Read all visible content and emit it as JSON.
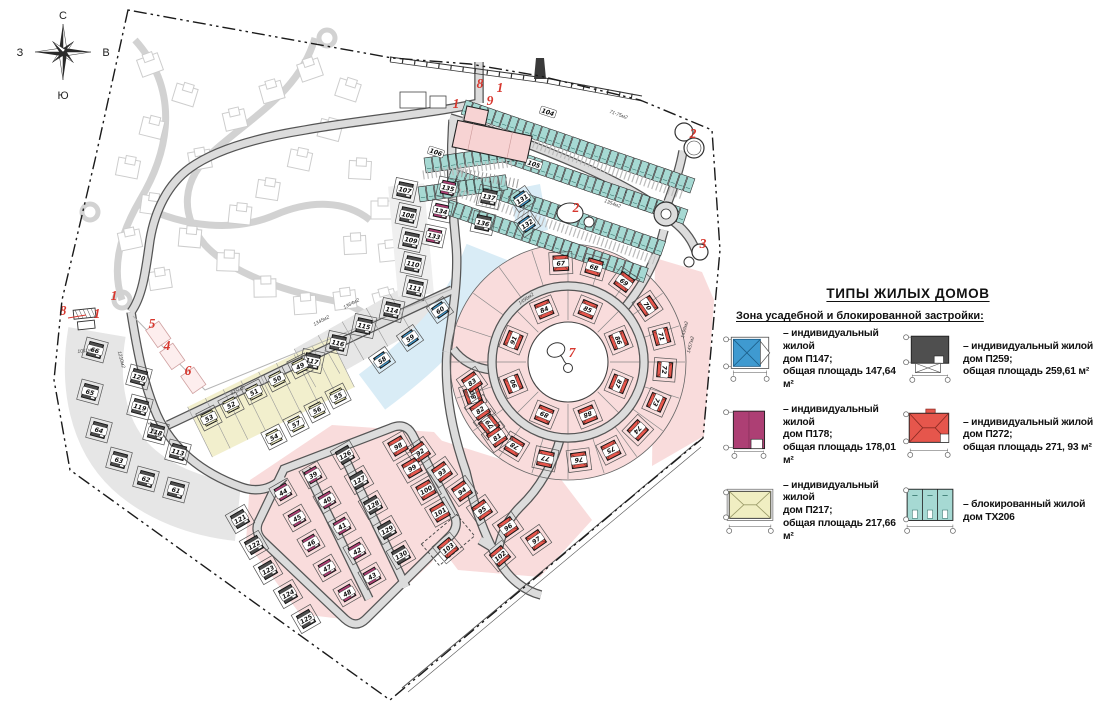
{
  "compass": {
    "n": "С",
    "s": "Ю",
    "w": "З",
    "e": "В"
  },
  "legend": {
    "title": "ТИПЫ ЖИЛЫХ ДОМОВ",
    "subtitle": "Зона усадебной и блокированной застройки:",
    "items": [
      {
        "id": "p147",
        "type": "П147",
        "house_color": "#3f9ad0",
        "lines": [
          "– индивидуальный жилой",
          "дом П147;",
          "общая площадь 147,64 м²"
        ]
      },
      {
        "id": "p259",
        "type": "П259",
        "house_color": "#4f4f4f",
        "lines": [
          "– индивидуальный жилой",
          "дом П259;",
          "общая площадь 259,61 м²"
        ]
      },
      {
        "id": "p178",
        "type": "П178",
        "house_color": "#ad3f74",
        "lines": [
          "– индивидуальный жилой",
          "дом П178;",
          "общая площадь 178,01 м²"
        ]
      },
      {
        "id": "p272",
        "type": "П272",
        "house_color": "#e6564c",
        "lines": [
          "– индивидуальный жилой",
          "дом П272;",
          "общая площадь 271, 93 м²"
        ]
      },
      {
        "id": "p217",
        "type": "П217",
        "house_color": "#f0eec2",
        "lines": [
          "– индивидуальный жилой",
          "дом П217;",
          "общая площадь 217,66 м²"
        ]
      },
      {
        "id": "tx206",
        "type": "ТХ206",
        "house_color": "#a6d9d3",
        "lines": [
          "– блокированный жилой",
          "дом ТХ206"
        ]
      }
    ]
  },
  "map": {
    "markers": [
      {
        "n": "1",
        "x": 114,
        "y": 300
      },
      {
        "n": "8",
        "x": 63,
        "y": 315
      },
      {
        "n": "1",
        "x": 97,
        "y": 318
      },
      {
        "n": "5",
        "x": 152,
        "y": 328
      },
      {
        "n": "4",
        "x": 167,
        "y": 350
      },
      {
        "n": "6",
        "x": 188,
        "y": 375
      },
      {
        "n": "1",
        "x": 456,
        "y": 108
      },
      {
        "n": "8",
        "x": 480,
        "y": 88
      },
      {
        "n": "1",
        "x": 500,
        "y": 92
      },
      {
        "n": "9",
        "x": 490,
        "y": 105
      },
      {
        "n": "2",
        "x": 693,
        "y": 138
      },
      {
        "n": "2",
        "x": 576,
        "y": 212
      },
      {
        "n": "3",
        "x": 703,
        "y": 248
      },
      {
        "n": "7",
        "x": 572,
        "y": 357
      }
    ],
    "zones": [
      {
        "name": "gray-arc",
        "type": "П259",
        "numbers": [
          "66",
          "65",
          "64",
          "63",
          "62",
          "61",
          "120",
          "119",
          "118",
          "113"
        ]
      },
      {
        "name": "gray-top-col",
        "type": "П259",
        "numbers": [
          "107",
          "108",
          "109",
          "110",
          "111",
          "114",
          "115",
          "116",
          "117"
        ]
      },
      {
        "name": "gray-grid-west",
        "type": "П259",
        "numbers": [
          "121",
          "122",
          "123",
          "124",
          "125"
        ]
      },
      {
        "name": "gray-grid-east",
        "type": "П259",
        "numbers": [
          "126",
          "127",
          "128",
          "129",
          "130"
        ]
      },
      {
        "name": "magenta-grid",
        "type": "П178",
        "numbers": [
          "44",
          "45",
          "46",
          "47",
          "48",
          "39",
          "40",
          "41",
          "42",
          "43"
        ]
      },
      {
        "name": "magenta-top",
        "type": "П178",
        "numbers": [
          "135",
          "134",
          "133"
        ]
      },
      {
        "name": "dark-top",
        "type": "П259",
        "numbers": [
          "137",
          "136"
        ]
      },
      {
        "name": "yellow-band",
        "type": "П217",
        "numbers": [
          "49",
          "50",
          "51",
          "52",
          "53",
          "55",
          "56",
          "57",
          "54"
        ]
      },
      {
        "name": "blue-band",
        "type": "П147",
        "numbers": [
          "58",
          "59",
          "60",
          "131",
          "132"
        ]
      },
      {
        "name": "circle-inner",
        "type": "П272",
        "numbers": [
          "84",
          "85",
          "86",
          "87",
          "88",
          "89",
          "90",
          "91"
        ]
      },
      {
        "name": "circle-outer",
        "type": "П272",
        "numbers": [
          "67",
          "68",
          "69",
          "70",
          "71",
          "72",
          "73",
          "74",
          "75",
          "76",
          "77",
          "78",
          "79",
          "80",
          "81",
          "82",
          "83"
        ]
      },
      {
        "name": "south-red",
        "type": "П272",
        "numbers": [
          "92",
          "93",
          "94",
          "95",
          "96",
          "97"
        ]
      },
      {
        "name": "east-red-col",
        "type": "П272",
        "numbers": [
          "98",
          "99",
          "100",
          "101"
        ]
      },
      {
        "name": "se-red",
        "type": "П272",
        "numbers": [
          "102",
          "103"
        ]
      },
      {
        "name": "townhouse-rows",
        "type": "ТХ206",
        "numbers": [
          "104",
          "105",
          "106"
        ]
      }
    ],
    "area_labels": [
      "71-75м2",
      "1495м2",
      "1499м2",
      "1457м2",
      "1364м2",
      "1345м2",
      "1354м2",
      "975м2",
      "1404м2",
      "1210м2",
      "1011м2"
    ]
  }
}
